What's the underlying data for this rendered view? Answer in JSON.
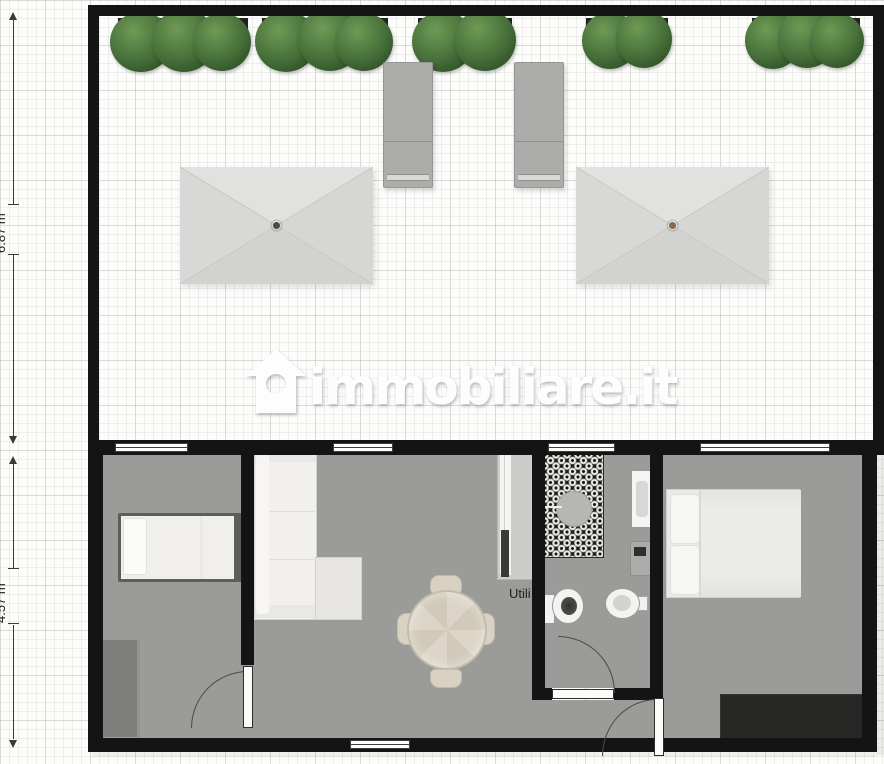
{
  "watermark": {
    "brand": "immobiliare.it",
    "icon": "immobiliare-house-icon"
  },
  "dimensions": [
    {
      "id": "terrace-depth",
      "label": "6.87 m"
    },
    {
      "id": "apartment-depth",
      "label": "4.57 m"
    }
  ],
  "labels": {
    "utility_room": "Utili"
  },
  "palette": {
    "wall": "#141414",
    "floor": "#9b9b9a",
    "grid_bg": "#fcfcfb",
    "plant_green": "#47703a",
    "umbrella_canvas": "#dbdbd9",
    "umbrella_dot_left": "#4a4a46",
    "umbrella_dot_right": "#8a6a4a",
    "shower_tile": "#1e1e1c",
    "rug": "#272725"
  }
}
